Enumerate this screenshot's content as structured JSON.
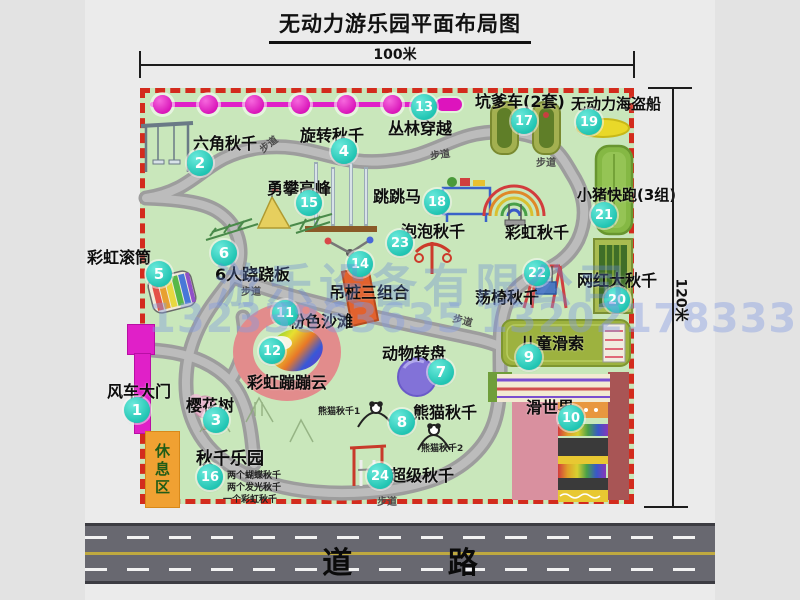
{
  "title": "无动力游乐园平面布局图",
  "dimensions": {
    "width_label": "100米",
    "height_label": "120米"
  },
  "road": {
    "label": "道 路"
  },
  "rest_area": {
    "label": "休息区"
  },
  "path_label": "步道",
  "rainbow_swing_label": "彩虹秋千",
  "watermark": {
    "company": "游乐设备有限公司",
    "phone": "13233863635 13202178333"
  },
  "colors": {
    "park_green": "#c9e7bb",
    "border_red": "#d32b1d",
    "badge_cyan": "#20c4b2",
    "zipline_magenta": "#e020c8",
    "road_gray": "#686870",
    "path_gray": "#a8a8a8",
    "rest_orange": "#f0a132",
    "watermark_blue": "#6e8cd7"
  },
  "attractions": [
    {
      "num": "1",
      "label": "风车大门"
    },
    {
      "num": "2",
      "label": "六角秋千"
    },
    {
      "num": "3",
      "label": "樱花树"
    },
    {
      "num": "4",
      "label": "旋转秋千"
    },
    {
      "num": "5",
      "label": "彩虹滚筒"
    },
    {
      "num": "6",
      "label": "6人跷跷板"
    },
    {
      "num": "7",
      "label": "动物转盘"
    },
    {
      "num": "8",
      "label": "熊猫秋千",
      "notes": [
        "熊猫秋千1",
        "熊猫秋千2"
      ]
    },
    {
      "num": "9",
      "label": "儿童滑索"
    },
    {
      "num": "10",
      "label": "滑世界"
    },
    {
      "num": "11",
      "label": "粉色沙滩"
    },
    {
      "num": "12",
      "label": "彩虹蹦蹦云"
    },
    {
      "num": "13",
      "label": "丛林穿越"
    },
    {
      "num": "14",
      "label": "吊桩三组合"
    },
    {
      "num": "15",
      "label": "勇攀高峰"
    },
    {
      "num": "16",
      "label": "秋千乐园",
      "notes": [
        "两个蝴蝶秋千",
        "两个发光秋千",
        "一个彩虹秋千"
      ]
    },
    {
      "num": "17",
      "label": "坑爹车(2套)"
    },
    {
      "num": "18",
      "label": "跳跳马"
    },
    {
      "num": "19",
      "label": "无动力海盗船"
    },
    {
      "num": "20",
      "label": "网红大秋千"
    },
    {
      "num": "21",
      "label": "小猪快跑(3组)"
    },
    {
      "num": "22",
      "label": "荡椅秋千"
    },
    {
      "num": "23",
      "label": "泡泡秋千"
    },
    {
      "num": "24",
      "label": "超级秋千"
    }
  ]
}
